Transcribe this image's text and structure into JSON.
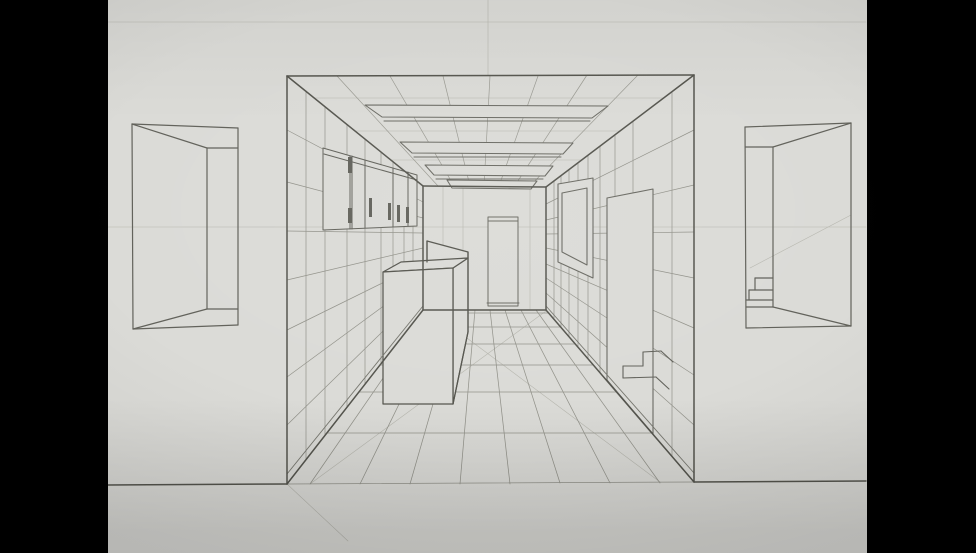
{
  "scene": {
    "description": "Photograph of a hand-drawn one-point perspective pencil sketch of a hallway interior (kitchen corridor with wall cabinet, island counter, ceiling beams, tiled floor, back doorway, picture frame and steps), flanked by two practice doorway vignettes, on light gray paper with black bars at left and right",
    "colors": {
      "letterbox": "#000000",
      "paper": "#dbdbd7",
      "pencil_dark": "#55554e",
      "pencil_mid": "#62625b",
      "pencil_soft": "#6a6a63",
      "pencil_grid": "#92928a",
      "pencil_light": "#9a9a92",
      "pencil_faint": "#b6b6ae",
      "baseboard": "#77776f"
    },
    "paper_left": 108,
    "paper_width": 759,
    "canvas_width": 976,
    "canvas_height": 553
  },
  "groups": [
    {
      "name": "construction-lines",
      "color": "pencil_faint",
      "w": 0.6,
      "lines": [
        [
          108,
          22,
          866,
          22
        ],
        [
          488,
          0,
          488,
          75
        ],
        [
          108,
          227,
          866,
          227
        ],
        [
          750,
          268,
          851,
          215
        ],
        [
          310,
          484,
          546,
          311
        ],
        [
          660,
          482,
          432,
          312
        ],
        [
          287,
          484,
          348,
          541
        ],
        [
          562,
          252,
          587,
          189
        ],
        [
          314,
          98,
          664,
          98
        ],
        [
          355,
          131,
          620,
          131
        ],
        [
          391,
          160,
          582,
          160
        ],
        [
          443,
          187,
          443,
          309
        ],
        [
          463,
          187,
          463,
          309
        ],
        [
          530,
          188,
          530,
          309
        ]
      ]
    },
    {
      "name": "ceiling-grid",
      "color": "pencil_light",
      "w": 0.7,
      "lines": [
        [
          337,
          76,
          438,
          186
        ],
        [
          390,
          76,
          454,
          186
        ],
        [
          443,
          76,
          470,
          186
        ],
        [
          490,
          76,
          484,
          186
        ],
        [
          538,
          76,
          499,
          186
        ],
        [
          587,
          75,
          514,
          187
        ],
        [
          638,
          75,
          529,
          187
        ]
      ]
    },
    {
      "name": "floor-grid",
      "color": "pencil_grid",
      "w": 0.75,
      "lines": [
        [
          421,
          313,
          549,
          313
        ],
        [
          410,
          327,
          561,
          327
        ],
        [
          397,
          344,
          575,
          344
        ],
        [
          380,
          365,
          593,
          365
        ],
        [
          359,
          392,
          616,
          392
        ],
        [
          327,
          433,
          651,
          433
        ],
        [
          310,
          484,
          430,
          310
        ],
        [
          360,
          484,
          445,
          310
        ],
        [
          410,
          484,
          460,
          310
        ],
        [
          460,
          484,
          475,
          310
        ],
        [
          510,
          484,
          490,
          310
        ],
        [
          560,
          483,
          505,
          310
        ],
        [
          610,
          483,
          521,
          310
        ],
        [
          660,
          483,
          536,
          310
        ],
        [
          287,
          484,
          694,
          482
        ]
      ]
    },
    {
      "name": "left-wall-grid",
      "color": "pencil_grid",
      "w": 0.7,
      "lines": [
        [
          287,
          130,
          423,
          202
        ],
        [
          287,
          182,
          423,
          218
        ],
        [
          287,
          231,
          423,
          233
        ],
        [
          287,
          280,
          423,
          248
        ],
        [
          287,
          330,
          423,
          263
        ],
        [
          287,
          377,
          423,
          277
        ],
        [
          287,
          425,
          423,
          292
        ],
        [
          306,
          91,
          306,
          460
        ],
        [
          325,
          107,
          325,
          435
        ],
        [
          347,
          125,
          347,
          407
        ],
        [
          365,
          139,
          365,
          384
        ],
        [
          381,
          152,
          381,
          364
        ],
        [
          393,
          162,
          393,
          348
        ],
        [
          404,
          171,
          404,
          334
        ],
        [
          413,
          178,
          413,
          323
        ]
      ]
    },
    {
      "name": "right-wall-grid",
      "color": "pencil_grid",
      "w": 0.7,
      "lines": [
        [
          694,
          130,
          546,
          204
        ],
        [
          694,
          185,
          546,
          220
        ],
        [
          694,
          232,
          546,
          234
        ],
        [
          694,
          278,
          546,
          248
        ],
        [
          694,
          328,
          546,
          264
        ],
        [
          694,
          375,
          546,
          278
        ],
        [
          694,
          425,
          546,
          293
        ],
        [
          672,
          92,
          672,
          456
        ],
        [
          633,
          121,
          633,
          411
        ],
        [
          615,
          135,
          615,
          390
        ],
        [
          600,
          146,
          600,
          372
        ],
        [
          588,
          155,
          588,
          358
        ],
        [
          578,
          163,
          578,
          346
        ],
        [
          569,
          170,
          569,
          336
        ],
        [
          561,
          176,
          561,
          327
        ],
        [
          554,
          181,
          554,
          318
        ]
      ]
    },
    {
      "name": "right-wall-doorway",
      "color": "pencil_soft",
      "w": 1.1,
      "fill": "paper",
      "polys": [
        [
          [
            607,
            198
          ],
          [
            653,
            189
          ],
          [
            653,
            434
          ],
          [
            607,
            380
          ]
        ]
      ]
    },
    {
      "name": "stairs",
      "color": "pencil_mid",
      "w": 1.1,
      "lines": [
        [
          643,
          352,
          661,
          351
        ],
        [
          643,
          352,
          643,
          366
        ],
        [
          623,
          366,
          643,
          366
        ],
        [
          623,
          366,
          623,
          378
        ],
        [
          623,
          378,
          656,
          377
        ],
        [
          661,
          351,
          673,
          362
        ],
        [
          656,
          377,
          669,
          389
        ]
      ]
    },
    {
      "name": "picture-frame",
      "color": "pencil_soft",
      "w": 1.1,
      "fill": "paper",
      "polys": [
        [
          [
            558,
            184
          ],
          [
            593,
            178
          ],
          [
            593,
            278
          ],
          [
            558,
            262
          ]
        ],
        [
          [
            562,
            193
          ],
          [
            587,
            188
          ],
          [
            587,
            265
          ],
          [
            562,
            252
          ]
        ]
      ]
    },
    {
      "name": "back-doorway",
      "color": "pencil_soft",
      "w": 1.0,
      "fill": "paper",
      "polys": [
        [
          [
            488,
            217
          ],
          [
            518,
            217
          ],
          [
            518,
            306
          ],
          [
            488,
            306
          ]
        ]
      ],
      "lines": [
        [
          488,
          221,
          518,
          221
        ],
        [
          487,
          303,
          519,
          303
        ]
      ]
    },
    {
      "name": "wall-cabinet",
      "color": "pencil_mid",
      "w": 1.0,
      "fill": "paper",
      "polys": [
        [
          [
            323,
            148
          ],
          [
            417,
            175
          ],
          [
            417,
            226
          ],
          [
            323,
            230
          ]
        ]
      ],
      "lines": [
        [
          324,
          154,
          417,
          180
        ],
        [
          350,
          156,
          350,
          229
        ],
        [
          352,
          156,
          352,
          229
        ],
        [
          365,
          160,
          365,
          228
        ],
        [
          393,
          168,
          393,
          227
        ],
        [
          408,
          172,
          408,
          226
        ]
      ],
      "rects": [
        [
          348,
          157,
          4,
          16
        ],
        [
          348,
          208,
          4,
          15
        ],
        [
          369,
          198,
          3,
          19
        ],
        [
          388,
          203,
          3,
          17
        ],
        [
          397,
          205,
          3,
          17
        ],
        [
          406,
          207,
          3,
          16
        ]
      ]
    },
    {
      "name": "kitchen-island",
      "color": "pencil_dark",
      "w": 1.25,
      "fill": "paper",
      "polys": [
        [
          [
            427,
            241
          ],
          [
            468,
            252
          ],
          [
            468,
            258
          ],
          [
            427,
            262
          ]
        ],
        [
          [
            453,
            268
          ],
          [
            468,
            258
          ],
          [
            468,
            332
          ],
          [
            453,
            404
          ]
        ],
        [
          [
            383,
            272
          ],
          [
            401,
            262
          ],
          [
            468,
            258
          ],
          [
            453,
            268
          ]
        ],
        [
          [
            383,
            272
          ],
          [
            453,
            268
          ],
          [
            453,
            404
          ],
          [
            383,
            404
          ]
        ]
      ],
      "lines": [
        [
          427,
          241,
          427,
          262
        ],
        [
          468,
          252,
          468,
          332
        ],
        [
          453,
          404,
          468,
          332
        ]
      ]
    },
    {
      "name": "ceiling-beams",
      "color": "pencil_soft",
      "w": 1.05,
      "fill": "paper",
      "polys": [
        [
          [
            365,
            105
          ],
          [
            608,
            106
          ],
          [
            592,
            118
          ],
          [
            382,
            117
          ]
        ],
        [
          [
            400,
            142
          ],
          [
            573,
            143
          ],
          [
            563,
            154
          ],
          [
            412,
            153
          ]
        ],
        [
          [
            425,
            165
          ],
          [
            553,
            166
          ],
          [
            545,
            176
          ],
          [
            434,
            175
          ]
        ],
        [
          [
            447,
            180
          ],
          [
            537,
            181
          ],
          [
            531,
            189
          ],
          [
            452,
            188
          ]
        ]
      ],
      "lines": [
        [
          384,
          121,
          590,
          121
        ],
        [
          414,
          157,
          561,
          157
        ],
        [
          436,
          179,
          543,
          179
        ]
      ]
    },
    {
      "name": "baseboards",
      "color": "baseboard",
      "w": 0.9,
      "lines": [
        [
          287,
          474,
          423,
          306
        ],
        [
          694,
          473,
          546,
          306
        ]
      ]
    },
    {
      "name": "room-structure",
      "color": "pencil_dark",
      "w": 1.5,
      "lines": [
        [
          287,
          76,
          287,
          484
        ],
        [
          694,
          75,
          694,
          482
        ],
        [
          287,
          76,
          694,
          75
        ],
        [
          287,
          76,
          423,
          186
        ],
        [
          694,
          75,
          546,
          187
        ],
        [
          287,
          484,
          423,
          310
        ],
        [
          694,
          482,
          546,
          310
        ],
        [
          423,
          186,
          423,
          310
        ],
        [
          546,
          187,
          546,
          310
        ],
        [
          423,
          186,
          546,
          187
        ],
        [
          423,
          310,
          546,
          310
        ],
        [
          108,
          485,
          287,
          484
        ],
        [
          694,
          482,
          866,
          481
        ]
      ]
    },
    {
      "name": "left-doorway-vignette",
      "color": "pencil_mid",
      "w": 1.2,
      "lines": [
        [
          132,
          124,
          238,
          128
        ],
        [
          132,
          124,
          133,
          329
        ],
        [
          238,
          128,
          238,
          325
        ],
        [
          133,
          329,
          238,
          325
        ],
        [
          207,
          148,
          207,
          309
        ],
        [
          132,
          124,
          207,
          148
        ],
        [
          207,
          148,
          238,
          148
        ],
        [
          133,
          329,
          207,
          309
        ],
        [
          207,
          309,
          238,
          309
        ]
      ]
    },
    {
      "name": "right-doorway-vignette",
      "color": "pencil_mid",
      "w": 1.2,
      "lines": [
        [
          745,
          127,
          851,
          123
        ],
        [
          745,
          127,
          746,
          328
        ],
        [
          851,
          123,
          851,
          326
        ],
        [
          746,
          328,
          851,
          326
        ],
        [
          773,
          147,
          773,
          307
        ],
        [
          745,
          147,
          773,
          147
        ],
        [
          773,
          147,
          851,
          123
        ],
        [
          746,
          307,
          773,
          307
        ],
        [
          773,
          307,
          851,
          326
        ],
        [
          755,
          278,
          773,
          278
        ],
        [
          755,
          278,
          755,
          290
        ],
        [
          749,
          290,
          773,
          290
        ],
        [
          749,
          290,
          749,
          300
        ],
        [
          746,
          300,
          773,
          300
        ]
      ]
    }
  ]
}
